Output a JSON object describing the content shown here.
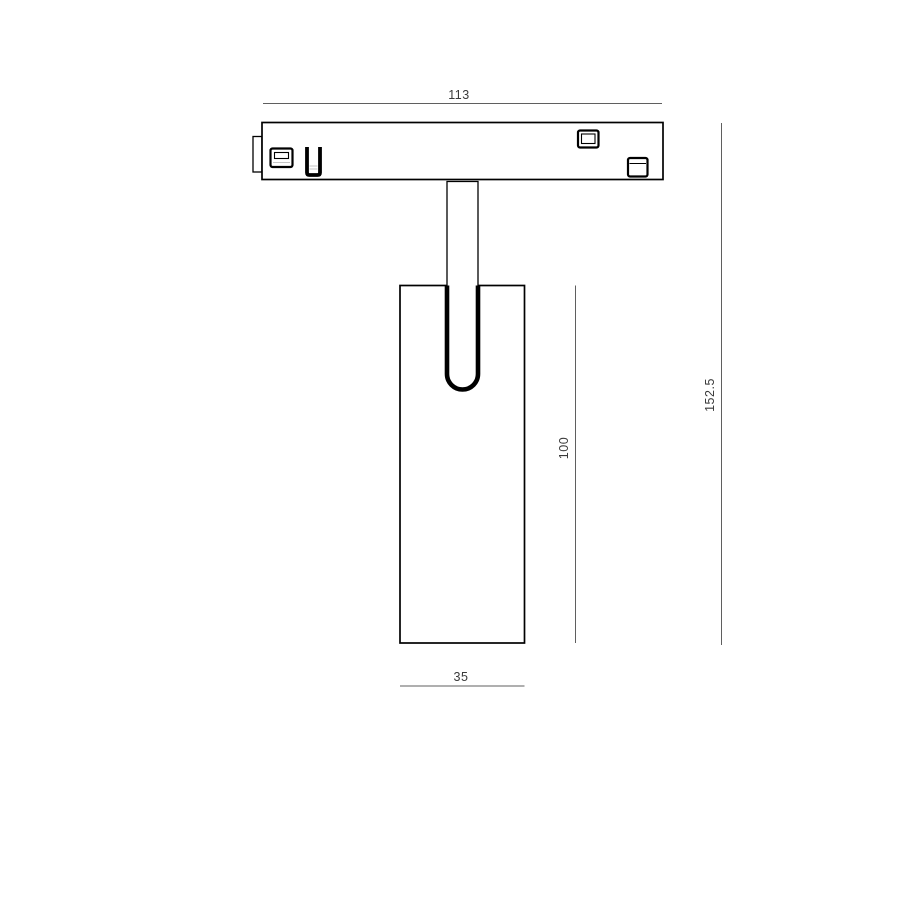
{
  "drawing": {
    "kind": "technical-dimension-drawing",
    "subject": "track-light-fixture-front-elevation",
    "dimensions": {
      "track_width": "113",
      "overall_height": "152.5",
      "body_height": "100",
      "body_width": "35"
    },
    "colors": {
      "outline": "#000000",
      "dimension_line": "#5f5f5f",
      "dimension_text": "#3a3a3a",
      "fill": "#ffffff",
      "shading": "#c4c4c4"
    }
  }
}
